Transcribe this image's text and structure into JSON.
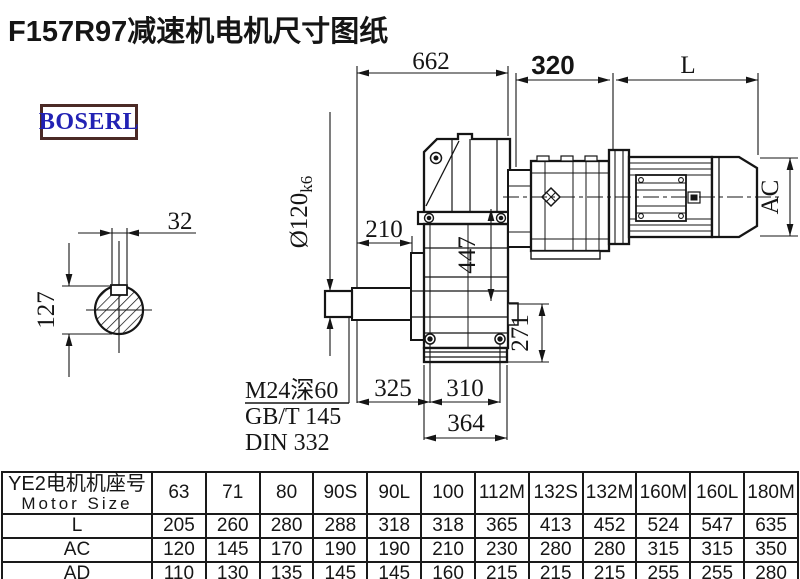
{
  "page": {
    "title": "F157R97减速机电机尺寸图纸",
    "brand": "BOSERL"
  },
  "drawing": {
    "dims": {
      "overall_length": "662",
      "adapter_length": "320",
      "motor_length": "L",
      "motor_diameter": "AC",
      "shaft_step": "210",
      "center_height": "447",
      "base_height": "271",
      "foot_offset": "325",
      "bolt_spacing": "310",
      "flange_width": "364",
      "key_width": "32",
      "shaft_drop": "127",
      "shaft_diameter": "Ø120",
      "shaft_tolerance": "k6"
    },
    "notes": {
      "tap": "M24深60",
      "standard_1": "GB/T 145",
      "standard_2": "DIN 332"
    }
  },
  "table": {
    "header_cn": "YE2电机机座号",
    "header_en": "Motor Size",
    "columns": [
      "63",
      "71",
      "80",
      "90S",
      "90L",
      "100",
      "112M",
      "132S",
      "132M",
      "160M",
      "160L",
      "180M"
    ],
    "rows": [
      {
        "label": "L",
        "values": [
          "205",
          "260",
          "280",
          "288",
          "318",
          "318",
          "365",
          "413",
          "452",
          "524",
          "547",
          "635"
        ]
      },
      {
        "label": "AC",
        "values": [
          "120",
          "145",
          "170",
          "190",
          "190",
          "210",
          "230",
          "280",
          "280",
          "315",
          "315",
          "350"
        ]
      },
      {
        "label": "AD",
        "values": [
          "110",
          "130",
          "135",
          "145",
          "145",
          "160",
          "215",
          "215",
          "215",
          "255",
          "255",
          "280"
        ]
      }
    ]
  }
}
